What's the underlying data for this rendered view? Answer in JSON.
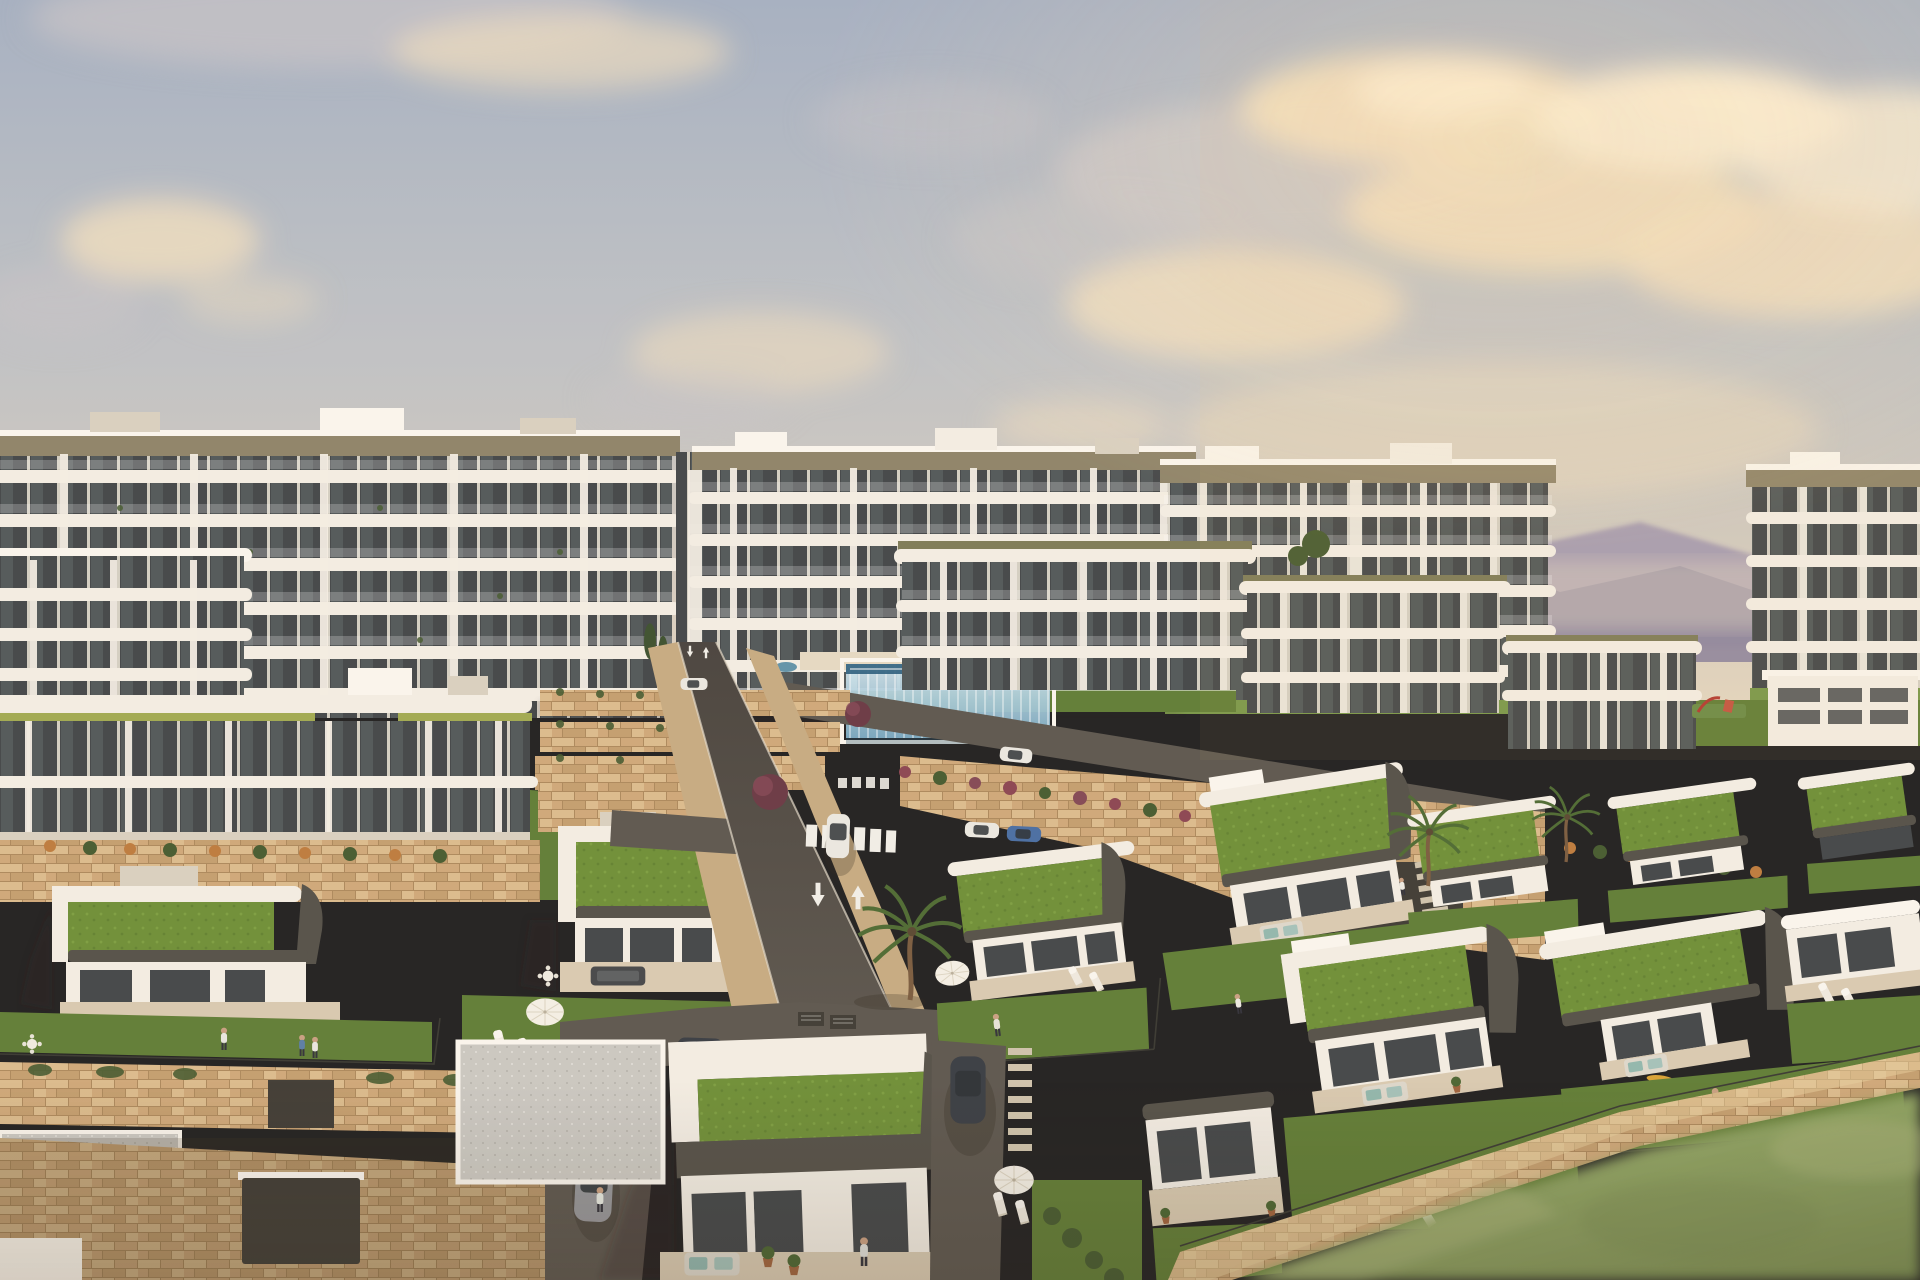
{
  "scene": {
    "type": "3d-architectural-render",
    "subject": "hillside coastal residential development: white apartment blocks behind rows of modern green-roof villas",
    "time_of_day": "golden hour",
    "camera": "aerial oblique view",
    "counts": {
      "apartment_blocks": 6,
      "villas": 14,
      "green_roofs": 12,
      "cars": 8,
      "people": 14,
      "pools": 2,
      "palm_trees": 3,
      "sun_umbrellas": 3,
      "road_arrows": 4,
      "crosswalks": 2
    }
  },
  "palette": {
    "sky_top": "#a6b1c3",
    "sky_mid": "#c0c3c6",
    "sky_horizon": "#e2d6c2",
    "cloud_cream": "#f0debf",
    "cloud_bright": "#f9eed6",
    "cloud_gray": "#c8c5c8",
    "mountain_far": "#a59bb1",
    "mountain_near": "#8e87a0",
    "hill_town": "#b3a28f",
    "wall_white": "#f3eee4",
    "wall_white_lit": "#faf6ee",
    "wall_shade": "#d9d1c1",
    "fascia_tan": "#8f856a",
    "fascia_olive": "#7e7c58",
    "lime_accent": "#a2ab52",
    "glazing": "#44484a",
    "glazing_lite": "#60696a",
    "pier_white": "#eee8da",
    "stone": "#c49f70",
    "stone_lite": "#dbbc8e",
    "stone_mid": "#cfa97a",
    "stone_dark": "#ad8a5d",
    "lawn": "#617e37",
    "lawn_lite": "#79984a",
    "grass_roof": "#6f9038",
    "grass_roof_lite": "#83a647",
    "taupe": "#55524a",
    "taupe_dark": "#403d36",
    "gravel": "#cbc9c2",
    "road": "#4a453f",
    "road_lite": "#5d5850",
    "sidewalk": "#c7ac83",
    "curb": "#e4dccb",
    "marking": "#f1efe8",
    "pool_glass_top": "#d3e7ef",
    "pool_glass_bot": "#7fb2cb",
    "pool_water": "#3f7d9b",
    "pool_rim": "#2a5e7e",
    "field": "#8ea262",
    "field_lite": "#a9b47a",
    "field_dark": "#7c9054",
    "fence": "#3a3a33",
    "palm": "#4f6c34",
    "shrub": "#475c31",
    "cypress": "#3d5230",
    "tree_red": "#6b3a46",
    "tree_red_lite": "#844a56",
    "flower_red": "#8c4753",
    "flower_orange": "#bd7c3e",
    "car_white": "#ebe9e2",
    "car_blue": "#4a6fa4",
    "car_dark": "#393e45",
    "car_gray": "#96979a",
    "skin": "#c9a183",
    "pants": "#33333b",
    "shadow": "rgba(47,40,28,0.25)",
    "sun_glow": "#ffdfae"
  }
}
